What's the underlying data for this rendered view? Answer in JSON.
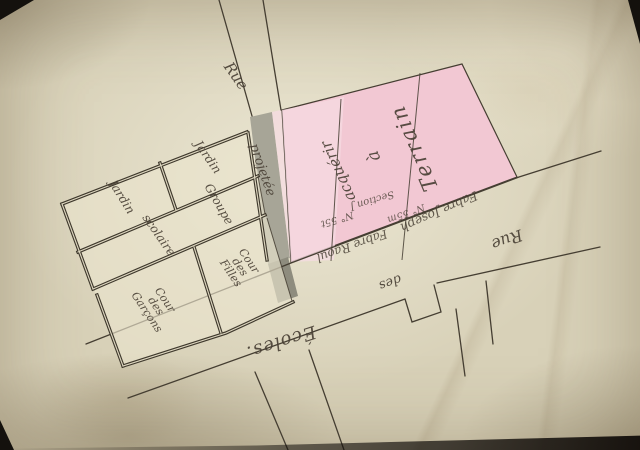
{
  "plan": {
    "streets": {
      "rue_top": "Rue",
      "projetee": "projetée",
      "rue_bottom": "Rue",
      "des": "des",
      "ecoles": "Écoles."
    },
    "terrain": {
      "terrain": "Terrain",
      "a": "à",
      "acquerir": "acquérir",
      "section": "Section J",
      "num_left": "N° 55t",
      "num_mid": "N° 55m",
      "fabre_raoul": "Fabre Raoul",
      "fabre_joseph": "Fabre Joseph"
    },
    "school": {
      "jardin_left": "Jardin",
      "jardin_strip": "Jardin",
      "groupe": "Groupe",
      "scolaire": "scolaire",
      "cour_filles": {
        "l1": "Cour",
        "l2": "des",
        "l3": "Filles"
      },
      "cour_garcons": {
        "l1": "Cour",
        "l2": "des",
        "l3": "Garçons"
      }
    }
  },
  "colors": {
    "paper": "#d8d1b8",
    "ink": "#4a4136",
    "line": "#453e32",
    "pink": "#f2c8d3",
    "pink-light": "#f6dbe2",
    "gray-street": "#a7a597",
    "gray-dark": "#8e8c7e",
    "wall-gap": "#ddd6bf"
  }
}
